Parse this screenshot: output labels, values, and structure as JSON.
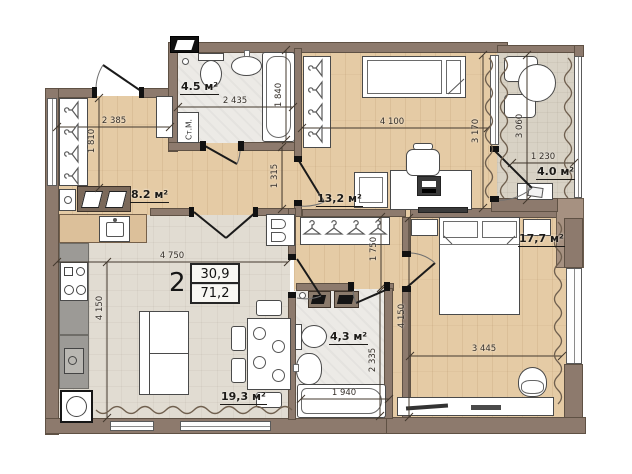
{
  "apartment": {
    "rooms_count": "2",
    "living_area": "30,9",
    "total_area": "71,2"
  },
  "room_labels": {
    "bathroom1": "4.5 м²",
    "hallway": "8.2 м²",
    "children": "13,2 м²",
    "balcony": "4.0 м²",
    "living": "19,3 м²",
    "bathroom2": "4,3 м²",
    "bedroom": "17,7 м²"
  },
  "appliance_labels": {
    "washing_machine": "Ст.М."
  },
  "dimensions": {
    "hallway_width": "2 385",
    "hallway_depth": "1 810",
    "bathroom1_width": "2 435",
    "bathroom1_depth": "1 840",
    "corridor_depth": "1 315",
    "children_width": "4 100",
    "children_depth": "3 170",
    "balcony_depth": "3 060",
    "balcony_width": "1 230",
    "living_width": "4 750",
    "living_depth": "4 150",
    "hall_depth": "1 750",
    "bedroom_full_depth": "4 150",
    "bathroom2_depth": "2 335",
    "bathtub2_width": "1 940",
    "bedroom_width": "3 445"
  },
  "colors": {
    "wall": "#8d7a6d",
    "wall_light": "#a69181",
    "wood_floor": "#e5cba5",
    "tile_floor": "#e1dcd2",
    "marble_floor": "#eceae6",
    "balcony_floor": "#d8d2c5"
  }
}
